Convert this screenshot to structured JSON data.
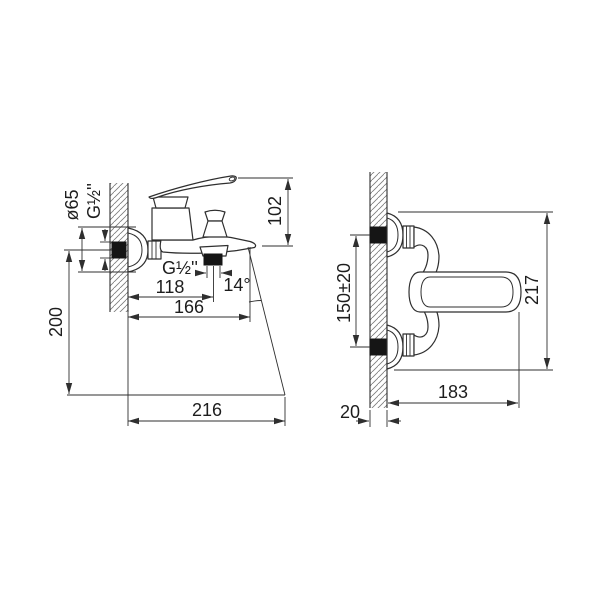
{
  "drawing": {
    "type": "faucet-installation-drawing",
    "background": "#ffffff",
    "line_color": "#2f2f2f",
    "accent_black": "#151515"
  },
  "side_view": {
    "dims": {
      "flange_diameter": "ø65",
      "wall_inlet_thread": "G½''",
      "body_height": "102",
      "shower_outlet_thread": "G½''",
      "wall_to_shower_outlet": "118",
      "spout_angle": "14°",
      "wall_to_spout_tip": "166",
      "inlet_axis_to_rim": "200",
      "spout_reach_at_rim": "216"
    }
  },
  "front_view": {
    "dims": {
      "connection_spacing": "150±20",
      "overall_height": "217",
      "overall_width": "183",
      "wall_thickness": "20"
    }
  }
}
